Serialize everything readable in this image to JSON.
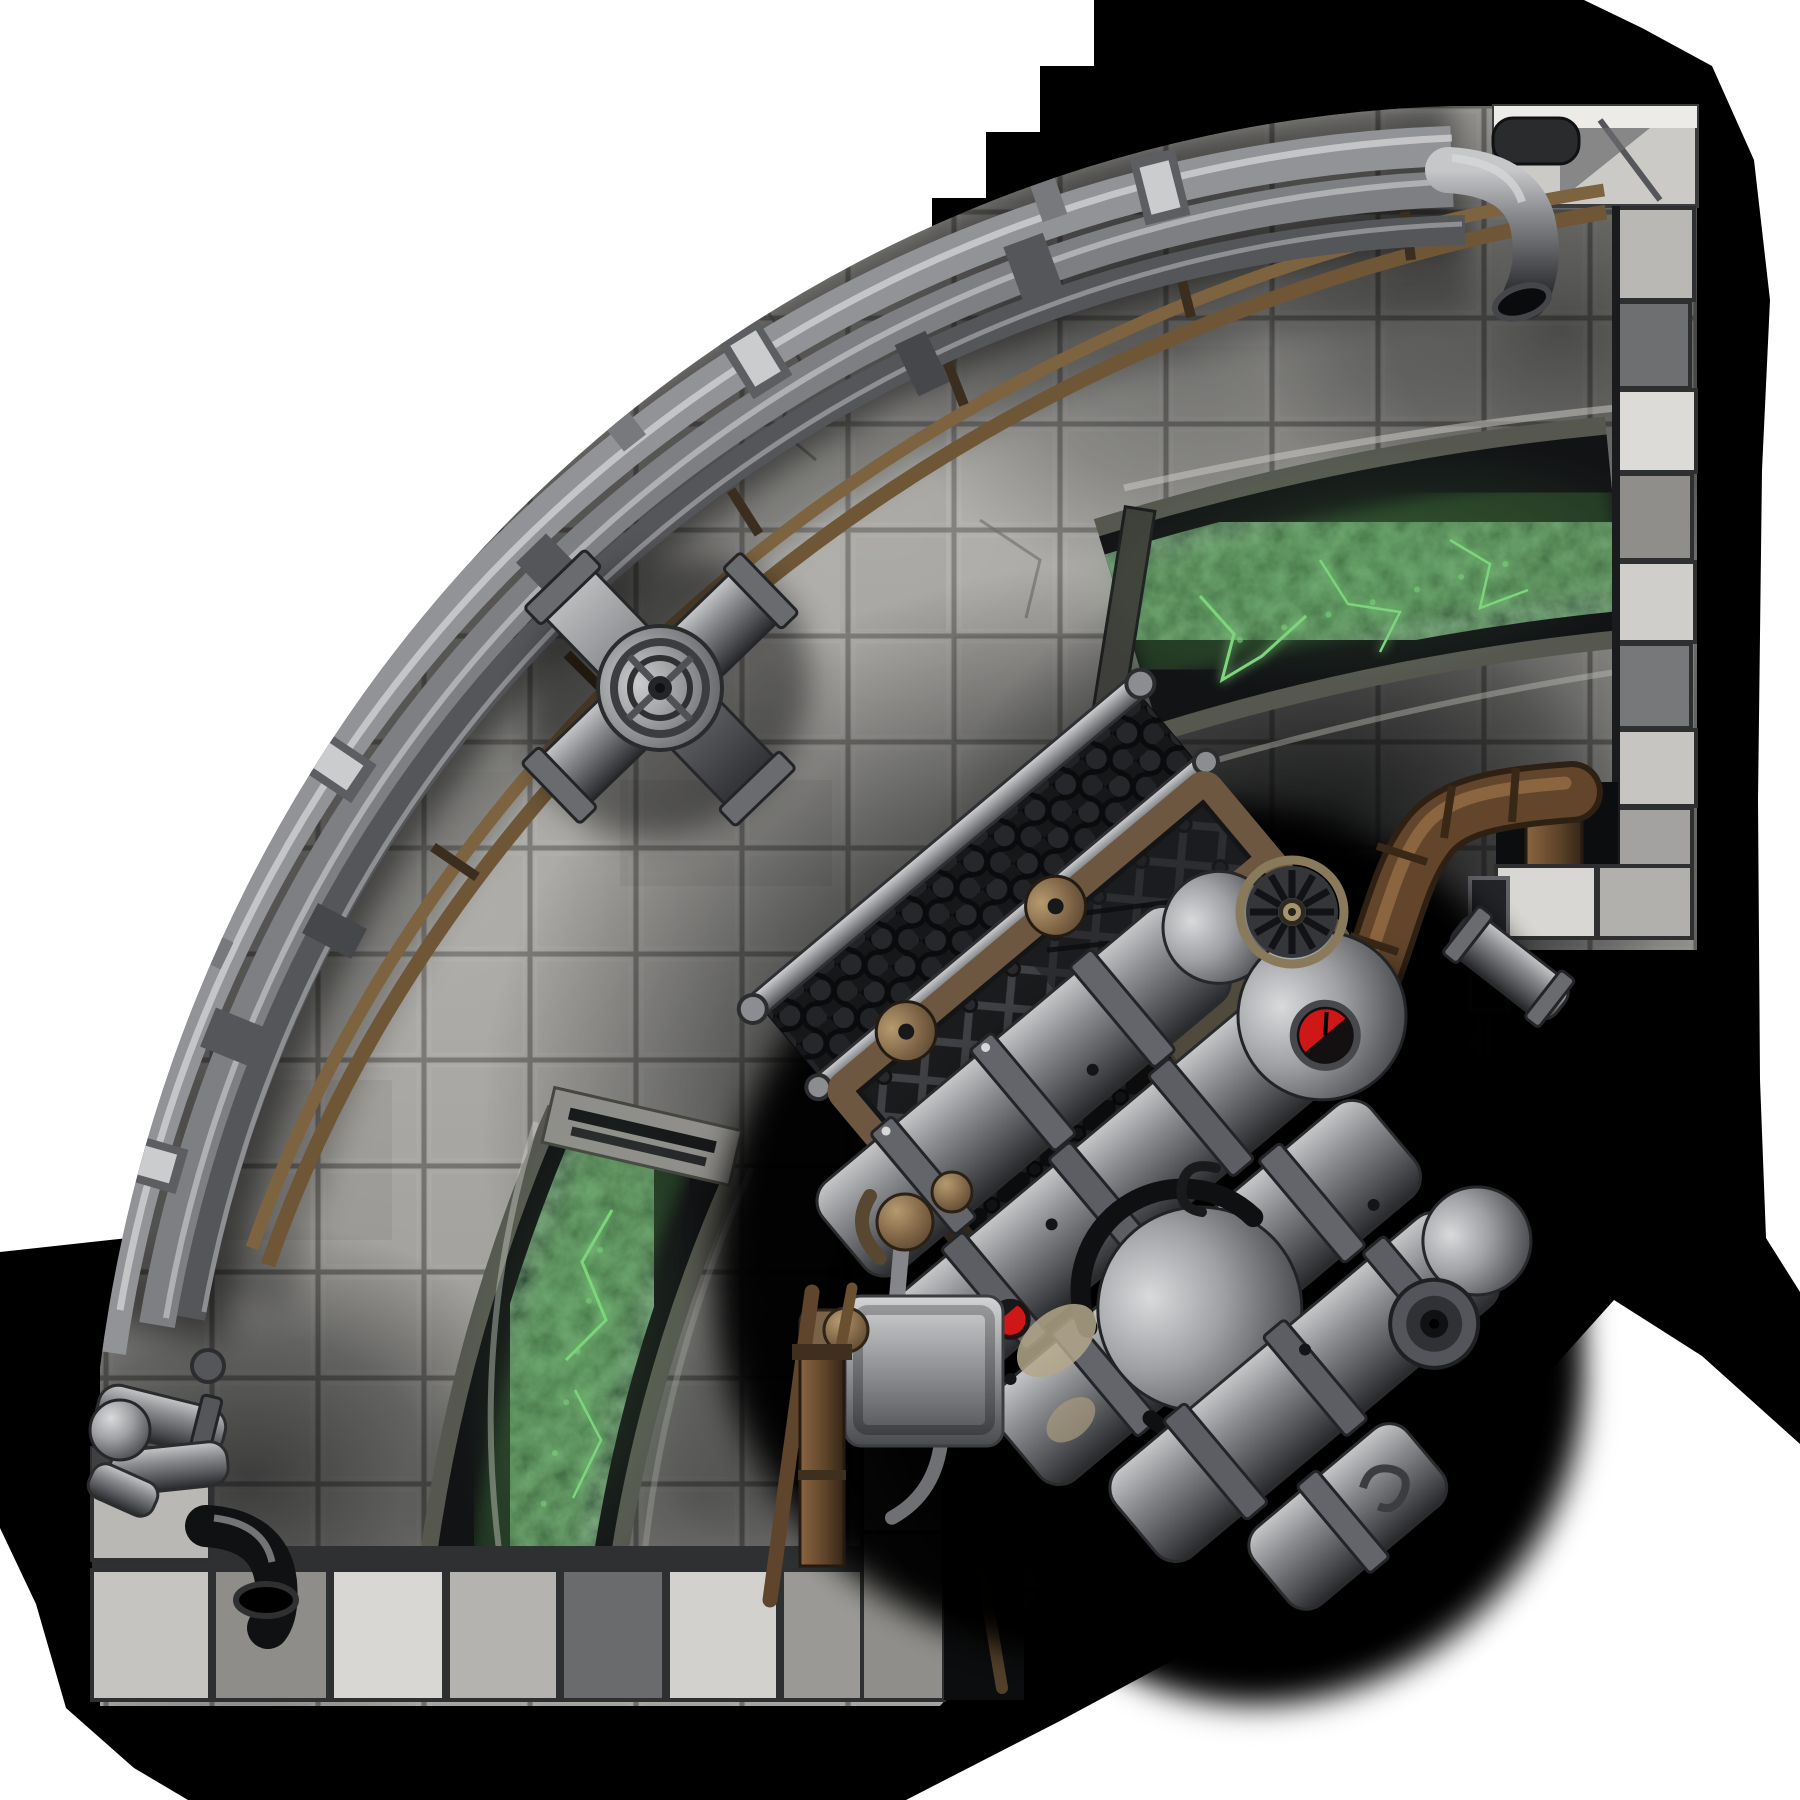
{
  "scene": {
    "kind": "top-down fantasy battlemap tile",
    "shape": "quarter-circle engine chamber",
    "tile_grid_px": 106
  },
  "colors": {
    "page_white": "#ffffff",
    "shadow": "#000000",
    "floor_base": "#a3a29e",
    "floor_grout": "#6f6e6a",
    "wall_light": "#cbcac6",
    "wall_mid": "#9b9a96",
    "wall_dark": "#4b4c4e",
    "pipe_silver": "#929396",
    "pipe_silver_dark": "#55565a",
    "pipe_bronze": "#6e5637",
    "wood_brown": "#63452b",
    "bronze_frame": "#6d5740",
    "channel_stone": "#56574f",
    "channel_rim": "#121315",
    "glow_green": "#7fd67f",
    "glow_green_soft": "#4f9a4a",
    "red_light": "#d01717",
    "machine_gray": "#8d8e91",
    "machine_dark": "#2b2c2e",
    "soot": "#141518",
    "beige_slab": "#b3a68a"
  },
  "features": {
    "walls": [
      {
        "id": "east-wall",
        "label": "stone block wall, east side"
      },
      {
        "id": "south-wall",
        "label": "stone block wall, south side"
      },
      {
        "id": "curved-wall",
        "label": "curved northwest rim lined with pipes"
      }
    ],
    "pipe_bundle": {
      "silver_pipes": 3,
      "bronze_pipes": 2,
      "valve_junctions": 1,
      "wall_elbows": 4
    },
    "glow_channels": [
      {
        "id": "upper",
        "label": "arc trench with green energy",
        "end": "meets east wall"
      },
      {
        "id": "lower",
        "label": "arc trench with green energy",
        "end": "meets south wall"
      }
    ],
    "machine": {
      "label": "large arcane engine",
      "parts": [
        "mesh cooling cage",
        "turbine fan",
        "boiler spheres",
        "flanged cylinders",
        "exhaust duct",
        "wood-brown feed pipe"
      ],
      "warning_lights": 2
    }
  }
}
